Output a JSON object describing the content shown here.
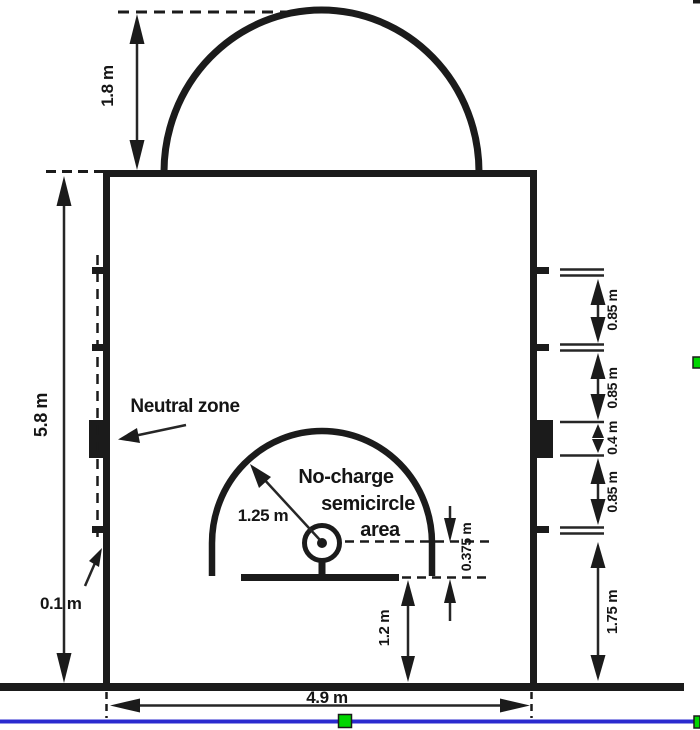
{
  "figure": {
    "type": "basketball-key-dimension-diagram",
    "dimensions": {
      "free_throw_circle_radius": "1.8 m",
      "key_length": "5.8 m",
      "hash_mark_length": "0.1 m",
      "key_width": "4.9 m",
      "no_charge_radius": "1.25 m",
      "ring_to_backboard": "0.375 m",
      "backboard_to_endline": "1.2 m",
      "lane_spaces": [
        "0.85 m",
        "0.85 m",
        "0.4 m",
        "0.85 m",
        "1.75 m"
      ]
    },
    "annotations": {
      "neutral_zone": "Neutral zone",
      "no_charge_line1": "No-charge",
      "no_charge_line2": "semicircle",
      "no_charge_line3": "area"
    },
    "colors": {
      "line": "#1b1b1b",
      "selection_border": "#2b2bcf",
      "selection_handle": "#00d600",
      "background": "#ffffff"
    }
  }
}
